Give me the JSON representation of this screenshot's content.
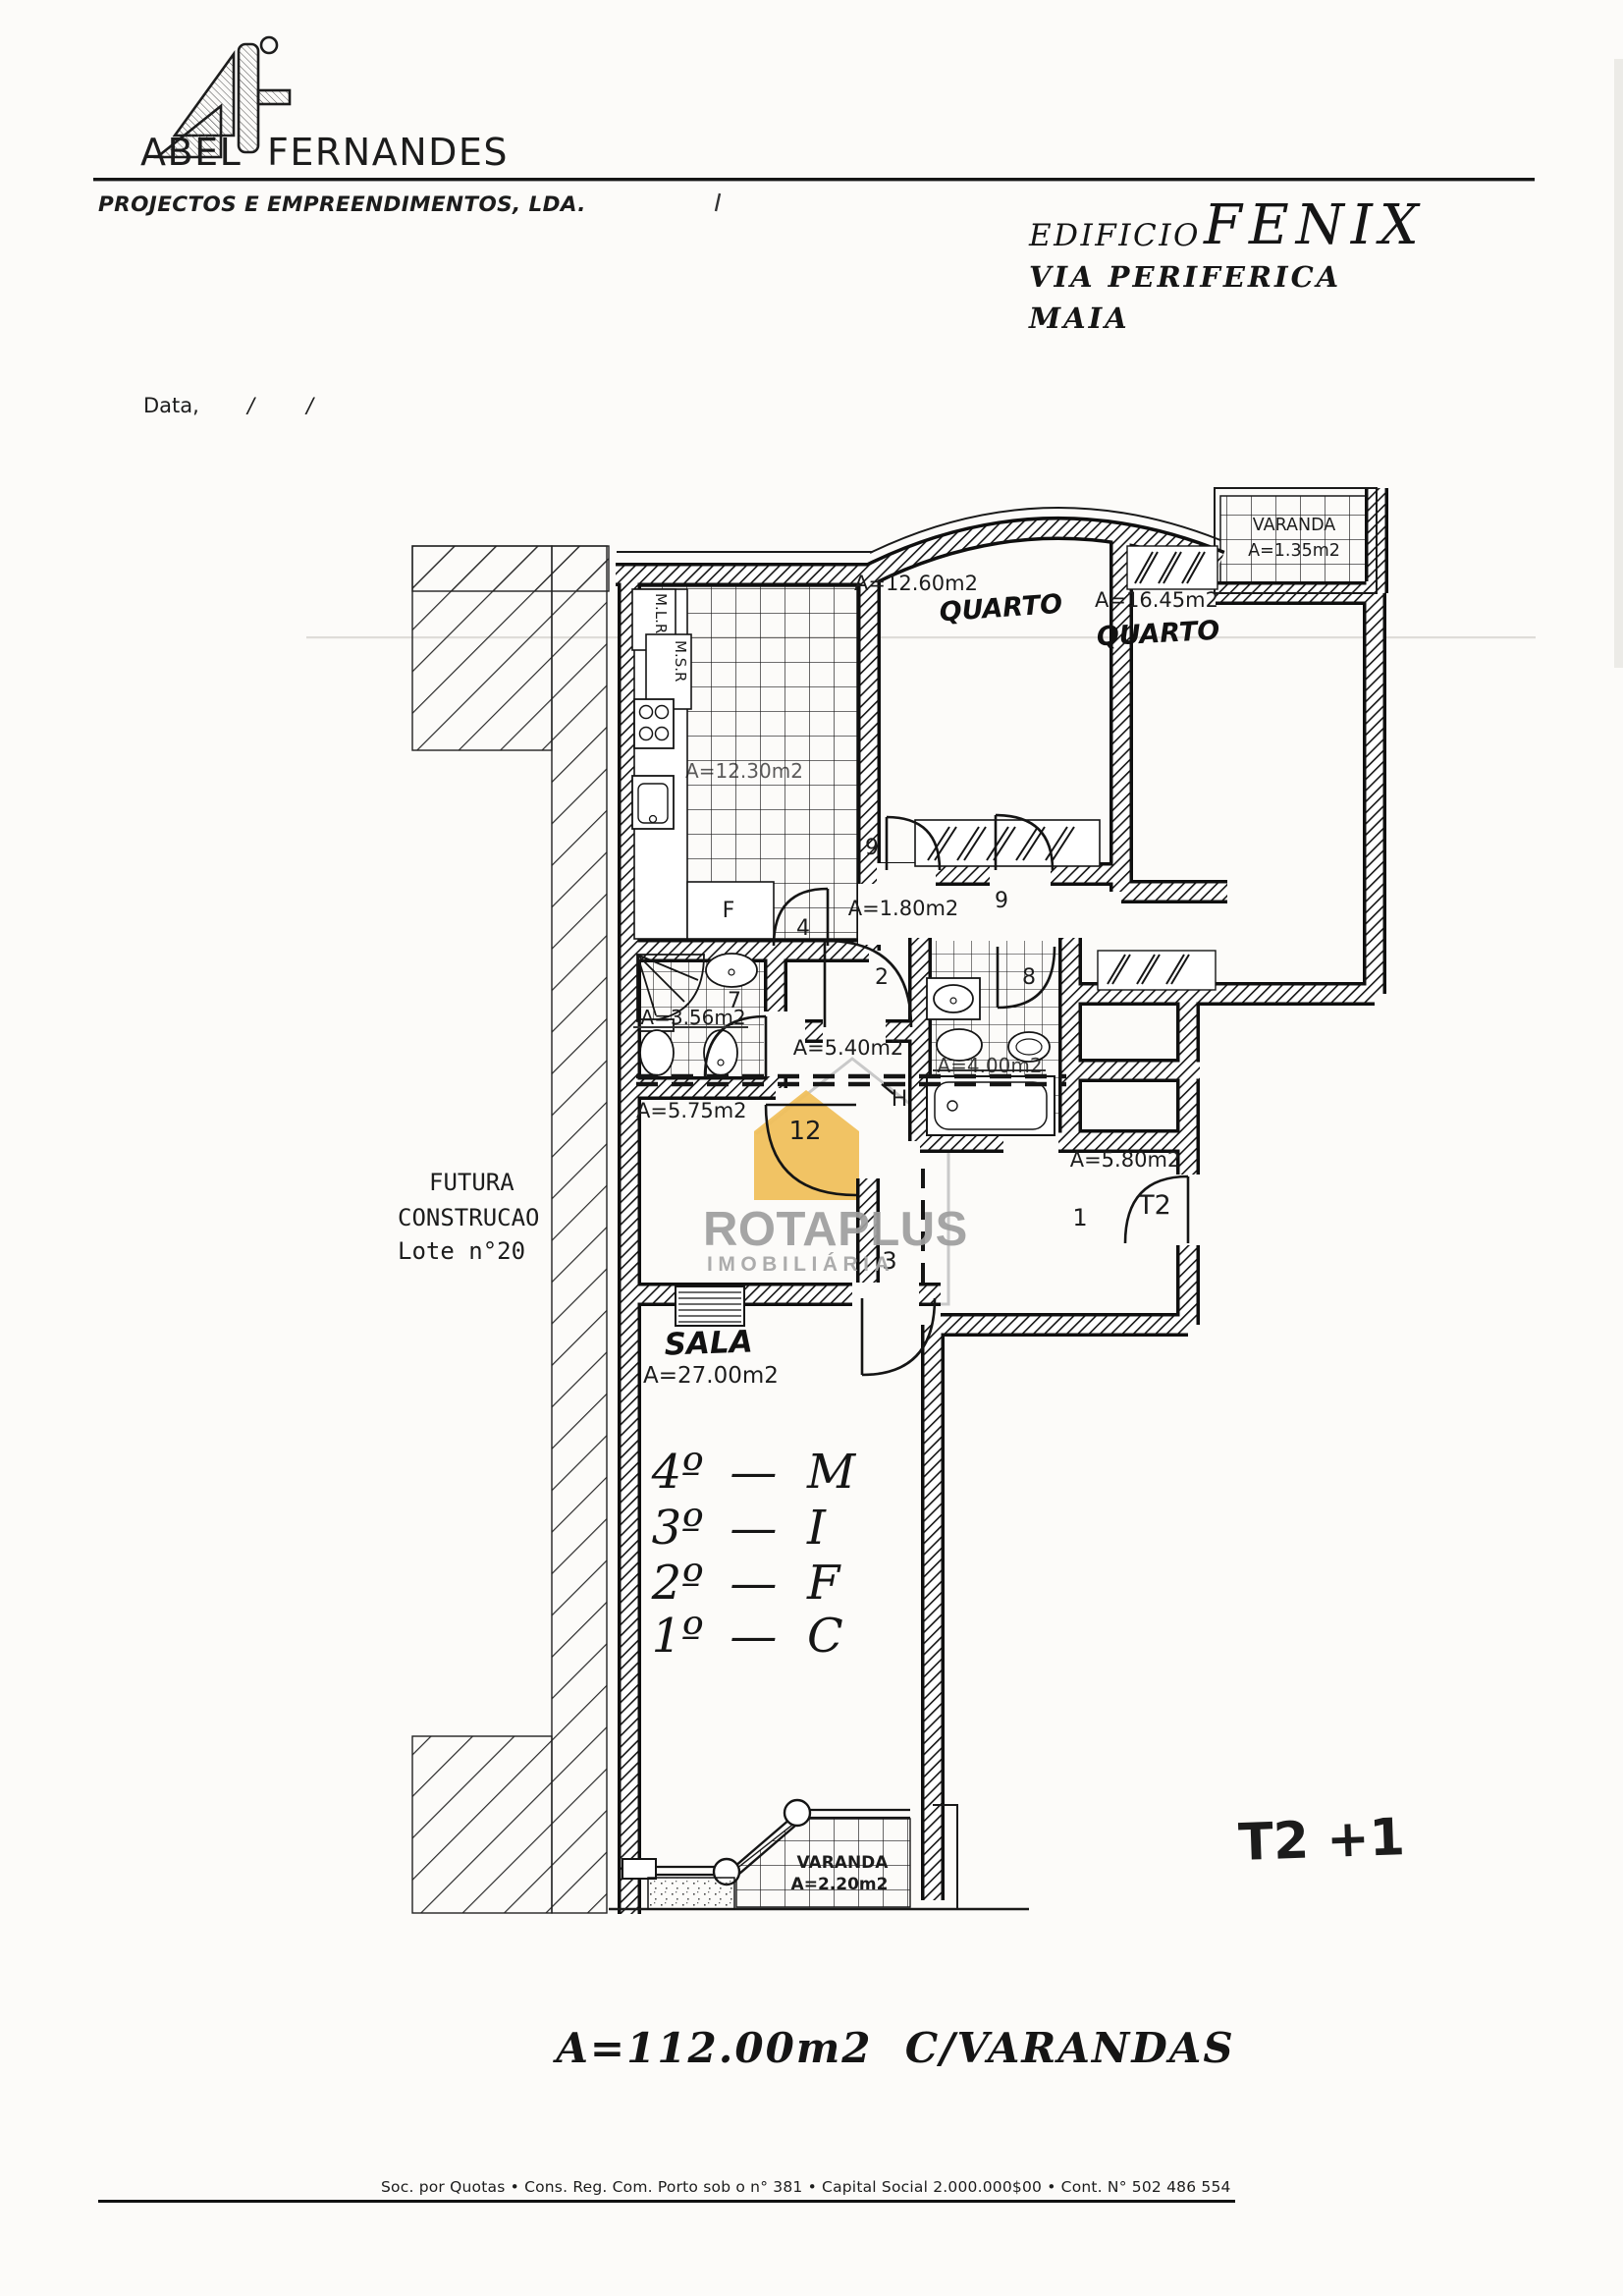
{
  "letterhead": {
    "company_first": "ABEL",
    "company_last": "FERNANDES",
    "subtitle": "PROJECTOS E EMPREENDIMENTOS, LDA.",
    "date_label": "Data,",
    "date_slash": "/"
  },
  "project": {
    "building_label": "EDIFICIO",
    "building_name": "FENIX",
    "street": "VIA  PERIFERICA",
    "city": "MAIA"
  },
  "plan": {
    "varanda_top": {
      "name": "VARANDA",
      "area": "A=1.35m2"
    },
    "quarto1": {
      "area": "A=12.60m2",
      "name": "QUARTO"
    },
    "quarto2": {
      "area": "A=16.45m2",
      "name": "QUARTO"
    },
    "cozinha": {
      "area": "A=12.30m2"
    },
    "closet_mlr": "M.L.R",
    "closet_msr": "M.S.R",
    "closet_f": "F",
    "hall_interior": {
      "area": "A=1.80m2"
    },
    "wc1": {
      "area": "A=3.56m2"
    },
    "corredor": {
      "area": "A=5.40m2"
    },
    "wc2": {
      "area": "A=4.00m2"
    },
    "hall_entrada": {
      "area": "A=5.75m2"
    },
    "hall_t2": {
      "area": "A=5.80m2"
    },
    "sala": {
      "name": "SALA",
      "area": "A=27.00m2"
    },
    "varanda_bottom": {
      "name": "VARANDA",
      "area": "A=2.20m2"
    },
    "doors": {
      "d9a": "9",
      "d9b": "9",
      "d4": "4",
      "d2": "2",
      "d7": "7",
      "d8": "8",
      "d12": "12",
      "d3": "3",
      "d1": "1",
      "dt2": "T2",
      "dh": "H"
    },
    "future": {
      "line1": "FUTURA",
      "line2": "CONSTRUCAO",
      "line3": "Lote n°20"
    }
  },
  "floors": {
    "rows": [
      {
        "level": "4º",
        "dash": "—",
        "unit": "M"
      },
      {
        "level": "3º",
        "dash": "—",
        "unit": "I"
      },
      {
        "level": "2º",
        "dash": "—",
        "unit": "F"
      },
      {
        "level": "1º",
        "dash": "—",
        "unit": "C"
      }
    ]
  },
  "annotations": {
    "typology": "T2 +1",
    "total_area": "A=112.00m2  C/VARANDAS"
  },
  "watermark": {
    "brand": "ROTAPLUS",
    "tagline": "IMOBILIÁRIA",
    "house_color": "#F0C05C",
    "text_color": "#9E9E9E"
  },
  "footer": {
    "legal": "Soc. por Quotas • Cons. Reg. Com. Porto sob o n°  381 • Capital Social 2.000.000$00 • Cont. N° 502 486 554"
  }
}
